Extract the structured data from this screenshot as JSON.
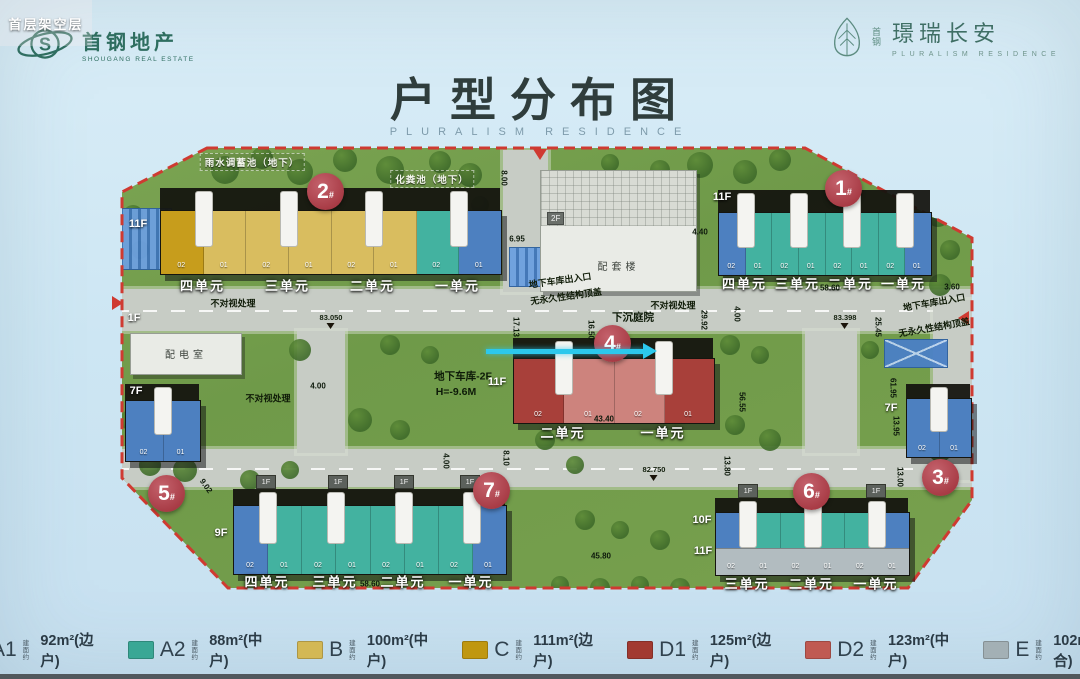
{
  "header": {
    "left_logo": {
      "brand": "首钢地产",
      "sub": "SHOUGANG REAL ESTATE"
    },
    "right_logo": {
      "pre": "首钢",
      "brand": "璟瑞长安",
      "sub": "PLURALISM RESIDENCE"
    }
  },
  "title": {
    "text": "户型分布图",
    "subtitle": "PLURALISM RESIDENCE"
  },
  "unit_types": {
    "A1": "#4d80c0",
    "A2": "#43b2a0",
    "B": "#d9bd5f",
    "C": "#c79d1c",
    "D1": "#a8403a",
    "D2": "#cd837d",
    "E": "#b2bcc0"
  },
  "legend": [
    {
      "code": "A1",
      "prefix": "建面约",
      "size": "92m²",
      "note": "(边户)",
      "color": "#4679bd"
    },
    {
      "code": "A2",
      "prefix": "建面约",
      "size": "88m²",
      "note": "(中户)",
      "color": "#3aa795"
    },
    {
      "code": "B",
      "prefix": "建面约",
      "size": "100m²",
      "note": "(中户)",
      "color": "#d3b855"
    },
    {
      "code": "C",
      "prefix": "建面约",
      "size": "111m²",
      "note": "(边户)",
      "color": "#c0970f"
    },
    {
      "code": "D1",
      "prefix": "建面约",
      "size": "125m²",
      "note": "(边户)",
      "color": "#a23a31"
    },
    {
      "code": "D2",
      "prefix": "建面约",
      "size": "123m²",
      "note": "(中户)",
      "color": "#c05a52"
    },
    {
      "code": "E",
      "prefix": "建面约",
      "size": "102m²",
      "note": "(顶合)",
      "color": "#a3b0b5"
    }
  ],
  "map": {
    "boundary_color": "#cf3a31",
    "tag_1f_label": "1F",
    "arrow": {
      "x1": 486,
      "y": 349,
      "x2": 644,
      "color": "#2cc8ec"
    },
    "buildings": [
      {
        "id": "2",
        "circle": {
          "x": 325,
          "y": 191
        },
        "slab": {
          "x": 160,
          "y": 210,
          "w": 340,
          "h": 63
        },
        "band": 22,
        "cells": [
          "C",
          "B",
          "B",
          "B",
          "B",
          "B",
          "A2",
          "A1"
        ],
        "cell_labels": [
          "02",
          "01",
          "02",
          "01",
          "02",
          "01",
          "02",
          "01"
        ],
        "sections": [
          "四单元",
          "三单元",
          "二单元",
          "一单元"
        ],
        "sec_y": 285,
        "floors": [
          {
            "t": "11F",
            "x": 138,
            "y": 224
          }
        ]
      },
      {
        "id": "1",
        "circle": {
          "x": 843,
          "y": 188
        },
        "slab": {
          "x": 718,
          "y": 212,
          "w": 212,
          "h": 62
        },
        "band": 22,
        "cells": [
          "A1",
          "A2",
          "A2",
          "A2",
          "A2",
          "A2",
          "A2",
          "A1"
        ],
        "cell_labels": [
          "02",
          "01",
          "02",
          "01",
          "02",
          "01",
          "02",
          "01"
        ],
        "sections": [
          "四单元",
          "三单元",
          "二单元",
          "一单元"
        ],
        "sec_y": 283,
        "floors": [
          {
            "t": "11F",
            "x": 722,
            "y": 197
          }
        ]
      },
      {
        "id": "4",
        "circle": {
          "x": 612,
          "y": 343
        },
        "slab": {
          "x": 513,
          "y": 358,
          "w": 200,
          "h": 64
        },
        "band": 20,
        "cells": [
          "D1",
          "D2",
          "D2",
          "D1"
        ],
        "cell_labels": [
          "02",
          "01",
          "02",
          "01"
        ],
        "sections": [
          "二单元",
          "一单元"
        ],
        "sec_y": 432,
        "floors": [
          {
            "t": "11F",
            "x": 497,
            "y": 382
          }
        ],
        "overlay": "首层架空层"
      },
      {
        "id": "5",
        "circle": {
          "x": 166,
          "y": 493
        },
        "slab": {
          "x": 125,
          "y": 400,
          "w": 74,
          "h": 60
        },
        "band": 16,
        "cells": [
          "A1",
          "A1"
        ],
        "cell_labels": [
          "02",
          "01"
        ],
        "sections": [],
        "floors": [
          {
            "t": "7F",
            "x": 136,
            "y": 391
          }
        ]
      },
      {
        "id": "3",
        "circle": {
          "x": 940,
          "y": 477
        },
        "slab": {
          "x": 906,
          "y": 398,
          "w": 64,
          "h": 58
        },
        "band": 14,
        "cells": [
          "A1",
          "A1"
        ],
        "cell_labels": [
          "02",
          "01"
        ],
        "sections": [],
        "floors": [
          {
            "t": "7F",
            "x": 891,
            "y": 408
          }
        ]
      },
      {
        "id": "7",
        "circle": {
          "x": 491,
          "y": 490
        },
        "slab": {
          "x": 233,
          "y": 505,
          "w": 272,
          "h": 68
        },
        "band": 16,
        "cells": [
          "A1",
          "A2",
          "A2",
          "A2",
          "A2",
          "A2",
          "A2",
          "A1"
        ],
        "cell_labels": [
          "02",
          "01",
          "02",
          "01",
          "02",
          "01",
          "02",
          "01"
        ],
        "sections": [
          "四单元",
          "三单元",
          "二单元",
          "一单元"
        ],
        "sec_y": 581,
        "floors": [
          {
            "t": "9F",
            "x": 221,
            "y": 533
          }
        ],
        "tags_1f": [
          265,
          337,
          403,
          469
        ]
      },
      {
        "id": "6",
        "circle": {
          "x": 811,
          "y": 491
        },
        "slab": {
          "x": 715,
          "y": 512,
          "w": 193,
          "h": 62
        },
        "band": 14,
        "cells": [
          "A1",
          "A2",
          "A2",
          "A2",
          "A2",
          "A1"
        ],
        "cell_labels": [
          "02",
          "01",
          "02",
          "01",
          "02",
          "01"
        ],
        "sections": [
          "三单元",
          "二单元",
          "一单元"
        ],
        "sec_y": 583,
        "floors": [
          {
            "t": "10F",
            "x": 702,
            "y": 520
          },
          {
            "t": "11F",
            "x": 703,
            "y": 551
          }
        ],
        "tags_1f": [
          747,
          875
        ],
        "bottom_strip": "E"
      }
    ],
    "service_buildings": [
      {
        "label": "配套楼",
        "x": 540,
        "y": 170,
        "w": 155,
        "h": 120,
        "tag": "2F",
        "grid_h": 55
      },
      {
        "label": "配电室",
        "x": 130,
        "y": 333,
        "w": 110,
        "h": 40
      }
    ],
    "labels": [
      {
        "t": "雨水调蓄池（地下）",
        "x": 252,
        "y": 162,
        "c": "wl"
      },
      {
        "t": "化粪池（地下）",
        "x": 432,
        "y": 179,
        "c": "wl"
      },
      {
        "t": "不对视处理",
        "x": 233,
        "y": 303,
        "c": "dl"
      },
      {
        "t": "不对视处理",
        "x": 268,
        "y": 398,
        "c": "dl"
      },
      {
        "t": "不对视处理",
        "x": 673,
        "y": 305,
        "c": "dl"
      },
      {
        "t": "下沉庭院",
        "x": 633,
        "y": 317,
        "c": "dl2"
      },
      {
        "t": "地下车库出入口",
        "x": 560,
        "y": 280,
        "c": "dl",
        "rot": -8
      },
      {
        "t": "无永久性结构顶盖",
        "x": 566,
        "y": 296,
        "c": "dl",
        "rot": -8
      },
      {
        "t": "地下车库出入口",
        "x": 934,
        "y": 302,
        "c": "dl",
        "rot": -10
      },
      {
        "t": "无永久性结构顶盖",
        "x": 934,
        "y": 327,
        "c": "dl",
        "rot": -10
      },
      {
        "t": "地下车库-2F",
        "x": 463,
        "y": 376,
        "c": "dl2"
      },
      {
        "t": "H=-9.6M",
        "x": 456,
        "y": 392,
        "c": "dl2"
      },
      {
        "t": "1F",
        "x": 134,
        "y": 318,
        "c": "fl"
      }
    ],
    "elevations": [
      {
        "t": "83.050",
        "x": 331,
        "y": 313
      },
      {
        "t": "83.398",
        "x": 845,
        "y": 313
      },
      {
        "t": "82.750",
        "x": 654,
        "y": 465
      }
    ],
    "dimensions": [
      {
        "t": "58.60",
        "x": 830,
        "y": 288
      },
      {
        "t": "4.40",
        "x": 700,
        "y": 232
      },
      {
        "t": "3.60",
        "x": 952,
        "y": 287
      },
      {
        "t": "8.00",
        "x": 504,
        "y": 178,
        "rot": 90
      },
      {
        "t": "17.13",
        "x": 516,
        "y": 327,
        "rot": 90
      },
      {
        "t": "16.50",
        "x": 591,
        "y": 330,
        "rot": 90
      },
      {
        "t": "29.92",
        "x": 704,
        "y": 320,
        "rot": 90
      },
      {
        "t": "4.00",
        "x": 737,
        "y": 314,
        "rot": 90
      },
      {
        "t": "25.45",
        "x": 878,
        "y": 327,
        "rot": 90
      },
      {
        "t": "61.95",
        "x": 893,
        "y": 388,
        "rot": 90
      },
      {
        "t": "56.55",
        "x": 742,
        "y": 402,
        "rot": 90
      },
      {
        "t": "13.95",
        "x": 896,
        "y": 426,
        "rot": 90
      },
      {
        "t": "13.00",
        "x": 900,
        "y": 477,
        "rot": 90
      },
      {
        "t": "4.00",
        "x": 318,
        "y": 386
      },
      {
        "t": "6.95",
        "x": 517,
        "y": 239
      },
      {
        "t": "9.02",
        "x": 206,
        "y": 486,
        "rot": 55
      },
      {
        "t": "4.00",
        "x": 446,
        "y": 461,
        "rot": 90
      },
      {
        "t": "8.10",
        "x": 506,
        "y": 458,
        "rot": 90
      },
      {
        "t": "13.80",
        "x": 727,
        "y": 466,
        "rot": 90
      },
      {
        "t": "58.60",
        "x": 370,
        "y": 584
      },
      {
        "t": "45.80",
        "x": 601,
        "y": 556
      },
      {
        "t": "43.40",
        "x": 604,
        "y": 419
      }
    ]
  }
}
